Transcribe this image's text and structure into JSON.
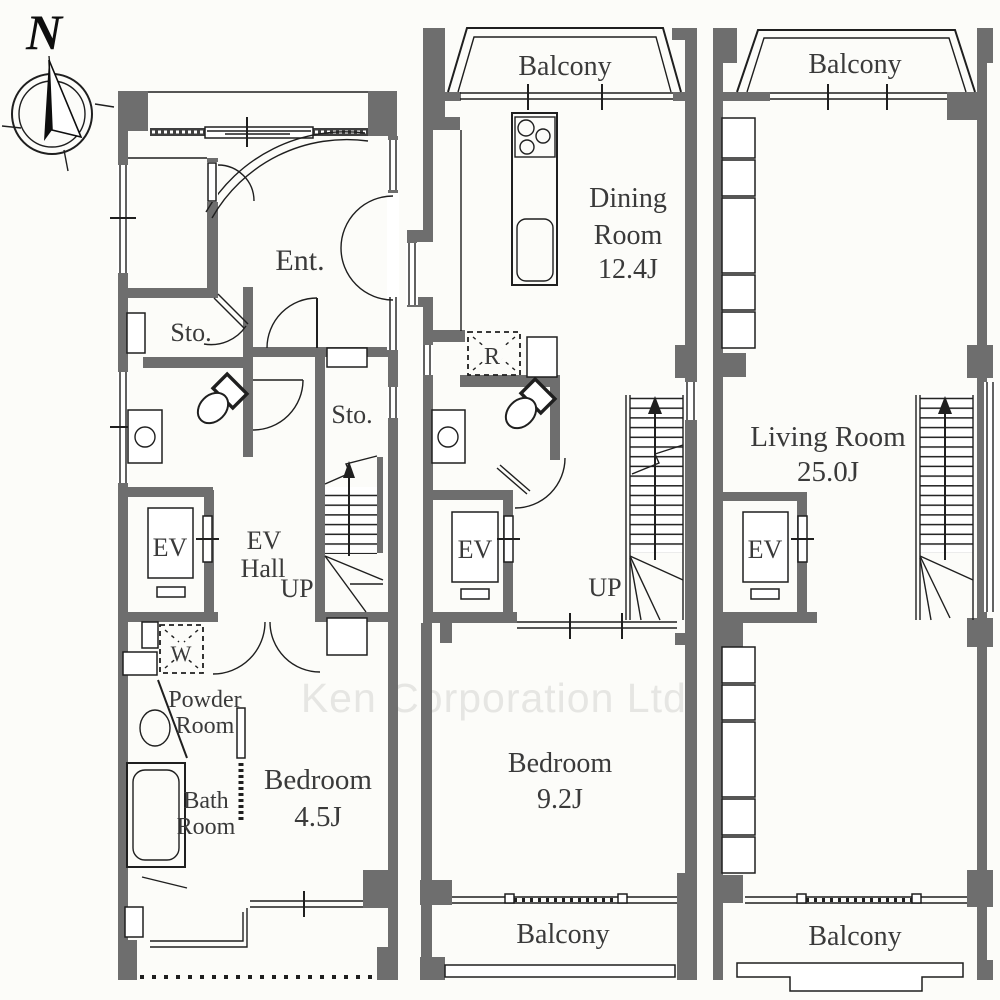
{
  "watermark": "Ken Corporation Ltd.",
  "compass": {
    "north_label": "N"
  },
  "colors": {
    "wall": "#6e6e6e",
    "line": "#1f1f1f",
    "label": "#3a3a3a",
    "watermark": "#e6e6e3",
    "background": "#fcfcf9",
    "louver": "#3f3f3f"
  },
  "floor1": {
    "entrance": "Ent.",
    "storage_a": "Sto.",
    "storage_b": "Sto.",
    "elevator": "EV",
    "ev_hall": [
      "EV",
      "Hall"
    ],
    "stairs_up": "UP",
    "washer": "W",
    "powder_room": [
      "Powder",
      "Room"
    ],
    "bath_room": [
      "Bath",
      "Room"
    ],
    "bedroom": [
      "Bedroom",
      "4.5J"
    ]
  },
  "floor2": {
    "balcony_top": "Balcony",
    "dining_room": [
      "Dining",
      "Room",
      "12.4J"
    ],
    "refrigerator": "R",
    "elevator": "EV",
    "stairs_up": "UP",
    "bedroom": [
      "Bedroom",
      "9.2J"
    ],
    "balcony_bottom": "Balcony"
  },
  "floor3": {
    "balcony_top": "Balcony",
    "living_room": [
      "Living Room",
      "25.0J"
    ],
    "elevator": "EV",
    "balcony_bottom": "Balcony"
  }
}
